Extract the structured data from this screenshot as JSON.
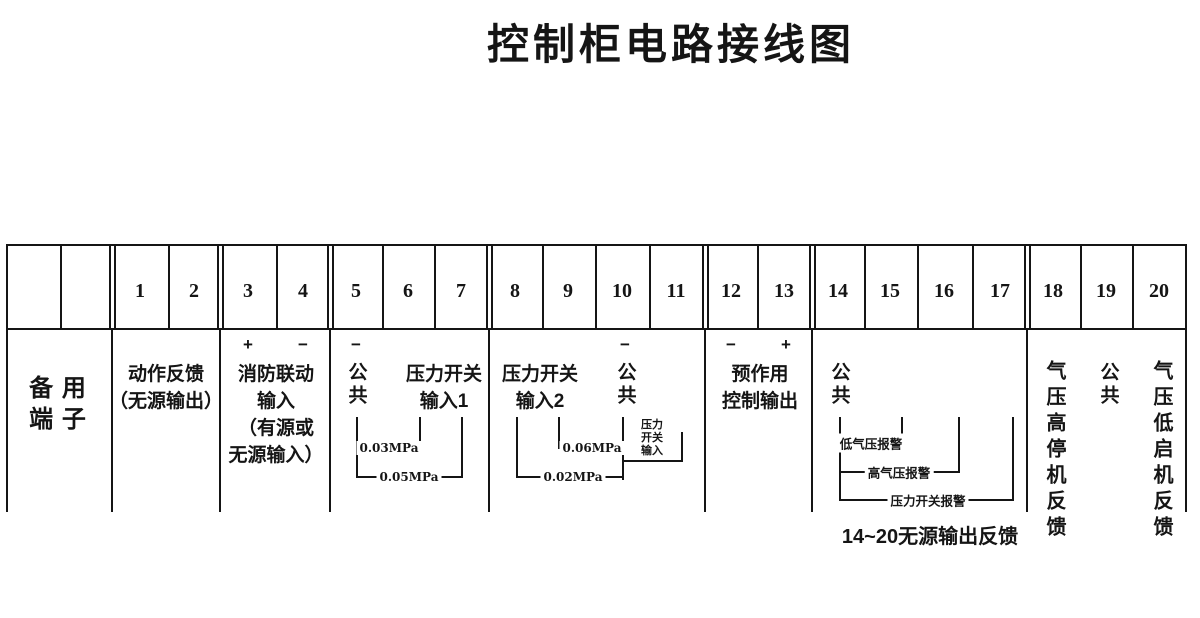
{
  "title": "控制柜电路接线图",
  "terminals": [
    "1",
    "2",
    "3",
    "4",
    "5",
    "6",
    "7",
    "8",
    "9",
    "10",
    "11",
    "12",
    "13",
    "14",
    "15",
    "16",
    "17",
    "18",
    "19",
    "20"
  ],
  "signs": {
    "plus": "+",
    "minus": "−"
  },
  "groups": {
    "spare": {
      "line1": "备 用",
      "line2": "端 子"
    },
    "action_feedback": {
      "line1": "动作反馈",
      "line2": "（无源输出）"
    },
    "fire_linkage": {
      "line1": "消防联动",
      "line2": "输入",
      "line3": "（有源或",
      "line4": "无源输入）"
    },
    "common": "公共",
    "pressure_input1": {
      "line1": "压力开关",
      "line2": "输入1"
    },
    "pressure_input2": {
      "line1": "压力开关",
      "line2": "输入2"
    },
    "preaction_output": {
      "line1": "预作用",
      "line2": "控制输出"
    },
    "high_pressure_stop_feedback": "气压高停机反馈",
    "low_pressure_start_feedback": "气压低启机反馈"
  },
  "annotations": {
    "mpa_0_03": "0.03MPa",
    "mpa_0_05": "0.05MPa",
    "mpa_0_06": "0.06MPa",
    "mpa_0_02": "0.02MPa",
    "pressure_switch_input": {
      "line1": "压力",
      "line2": "开关",
      "line3": "输入"
    },
    "low_air_pressure_alarm": "低气压报警",
    "high_air_pressure_alarm": "高气压报警",
    "pressure_switch_alarm": "压力开关报警",
    "caption_14_20": "14~20无源输出反馈"
  }
}
